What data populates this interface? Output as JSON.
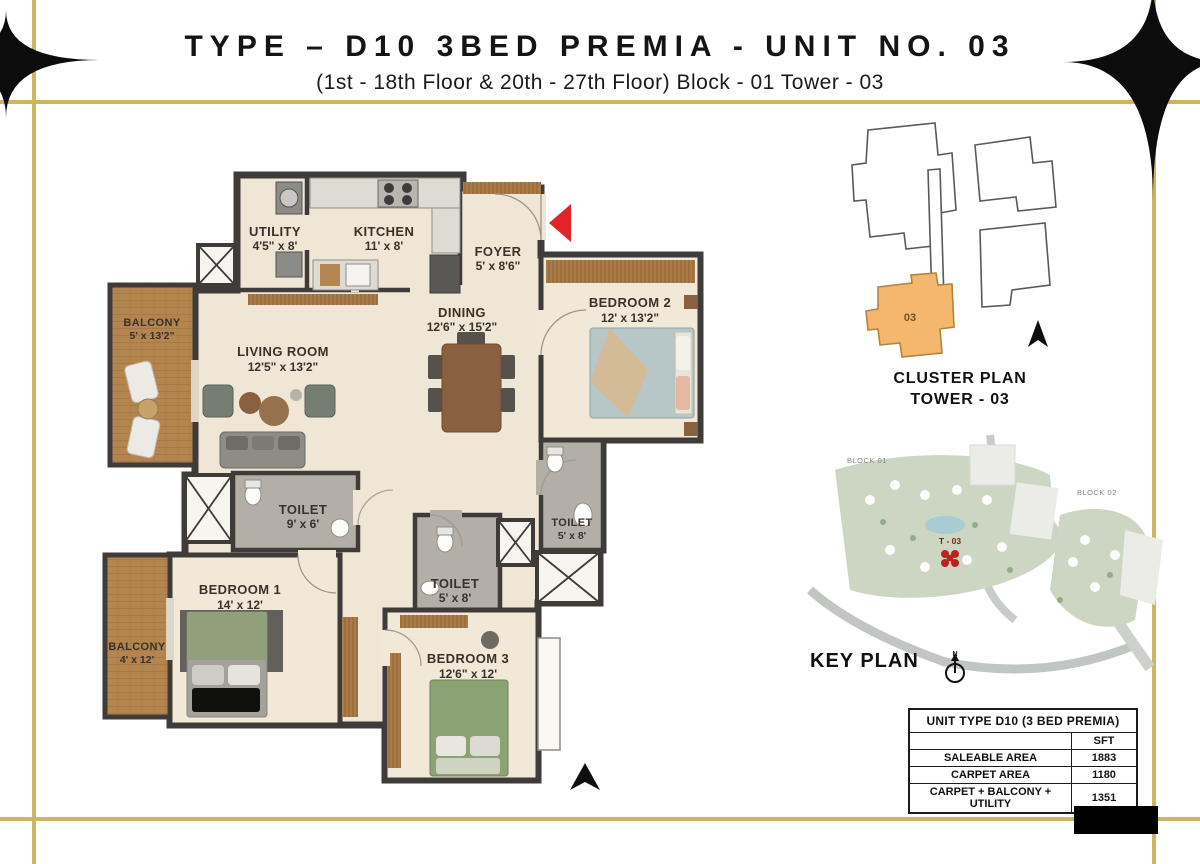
{
  "header": {
    "title": "TYPE – D10 3BED PREMIA - UNIT NO. 03",
    "subtitle": "(1st - 18th Floor  &  20th - 27th Floor) Block - 01 Tower - 03"
  },
  "floor_plan": {
    "rooms": [
      {
        "name": "UTILITY",
        "dim": "4'5\" x 8'"
      },
      {
        "name": "KITCHEN",
        "dim": "11' x 8'"
      },
      {
        "name": "FOYER",
        "dim": "5' x 8'6\""
      },
      {
        "name": "DINING",
        "dim": "12'6\" x 15'2\""
      },
      {
        "name": "LIVING ROOM",
        "dim": "12'5\" x 13'2\""
      },
      {
        "name": "BALCONY",
        "dim": "5' x 13'2\""
      },
      {
        "name": "BEDROOM 2",
        "dim": "12' x 13'2\""
      },
      {
        "name": "TOILET",
        "dim": "9' x 6'"
      },
      {
        "name": "TOILET",
        "dim": "5' x 8'"
      },
      {
        "name": "TOILET",
        "dim": "5' x 8'"
      },
      {
        "name": "BEDROOM 1",
        "dim": "14' x 12'"
      },
      {
        "name": "BALCONY",
        "dim": "4' x 12'"
      },
      {
        "name": "BEDROOM 3",
        "dim": "12'6\" x 12'"
      }
    ]
  },
  "cluster_plan": {
    "title_line1": "CLUSTER PLAN",
    "title_line2": "TOWER - 03",
    "highlight_label": "03"
  },
  "key_plan": {
    "title": "KEY PLAN",
    "block1": "BLOCK 01",
    "block2": "BLOCK 02",
    "tower_label": "T - 03",
    "compass": "N"
  },
  "area_table": {
    "header": "UNIT TYPE D10 (3 BED PREMIA)",
    "col_header": "SFT",
    "rows": [
      {
        "label": "SALEABLE AREA",
        "value": "1883"
      },
      {
        "label": "CARPET AREA",
        "value": "1180"
      },
      {
        "label": "CARPET + BALCONY + UTILITY",
        "value": "1351"
      }
    ]
  },
  "colors": {
    "gold_border": "#cdb65f",
    "wall": "#3e3b39",
    "floor": "#efe6d6",
    "entry_arrow_red": "#e02427",
    "cluster_highlight": "#f4b76d"
  }
}
